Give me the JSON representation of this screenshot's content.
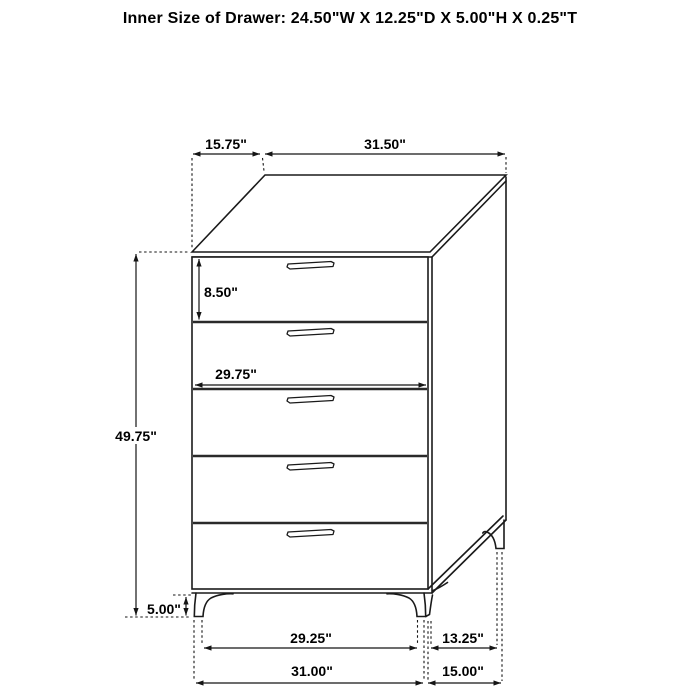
{
  "title": "Inner Size of Drawer: 24.50\"W X 12.25\"D X 5.00\"H X 0.25\"T",
  "diagram": {
    "type": "furniture-dimension-drawing",
    "item": "5-drawer chest",
    "drawer_count": 5,
    "view": "front three-quarter line drawing"
  },
  "dims": {
    "top_depth": "15.75\"",
    "top_width": "31.50\"",
    "drawer_front_height": "8.50\"",
    "inner_width": "29.75\"",
    "body_height": "49.75\"",
    "leg_height": "5.00\"",
    "front_leg_inner_span": "29.25\"",
    "side_leg_span": "13.25\"",
    "base_width": "31.00\"",
    "base_depth": "15.00\""
  },
  "colors": {
    "background": "#ffffff",
    "line": "#1a1a1a",
    "text": "#000000"
  }
}
